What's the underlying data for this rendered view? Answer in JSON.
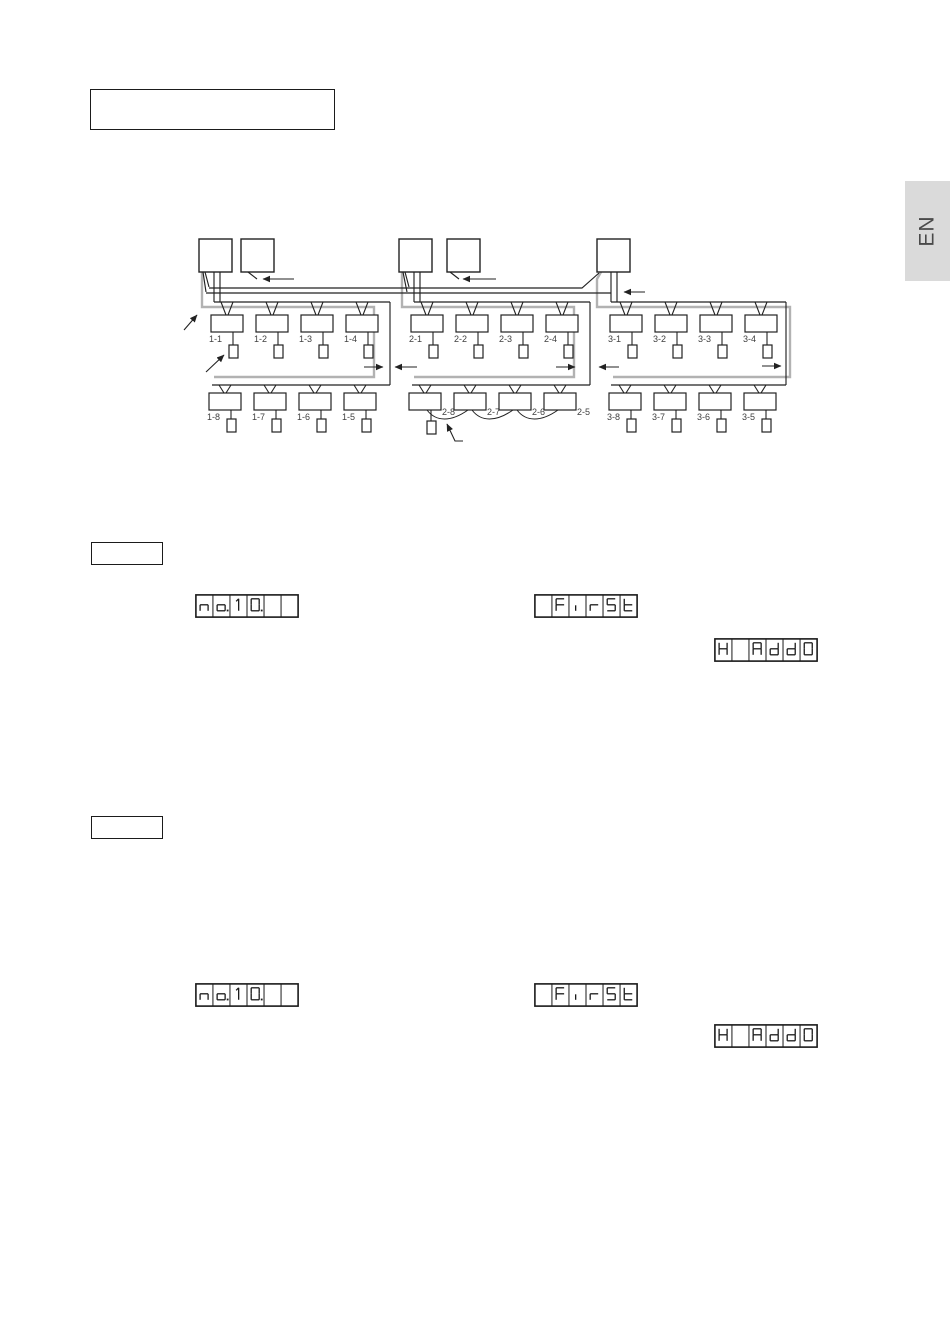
{
  "page": {
    "language_tab": "EN"
  },
  "diagram": {
    "groups": [
      {
        "id": "1",
        "outdoor_units": 2,
        "row1": [
          "1-1",
          "1-2",
          "1-3",
          "1-4"
        ],
        "row2": [
          "1-8",
          "1-7",
          "1-6",
          "1-5"
        ]
      },
      {
        "id": "2",
        "outdoor_units": 2,
        "row1": [
          "2-1",
          "2-2",
          "2-3",
          "2-4"
        ],
        "row2": [
          "2-8",
          "2-7",
          "2-6",
          "2-5"
        ],
        "row2_group_wiring": true
      },
      {
        "id": "3",
        "outdoor_units": 1,
        "row1": [
          "3-1",
          "3-2",
          "3-3",
          "3-4"
        ],
        "row2": [
          "3-8",
          "3-7",
          "3-6",
          "3-5"
        ]
      }
    ],
    "colors": {
      "line": "#222222",
      "bus_highlight": "#b2b2b2",
      "label": "#3f3f3f"
    }
  },
  "displays": [
    {
      "name": "no-10",
      "cells": [
        "n",
        "o.",
        "1",
        "0.",
        "",
        ""
      ]
    },
    {
      "name": "first",
      "cells": [
        "",
        "F",
        "i",
        "r",
        "S",
        "t"
      ]
    },
    {
      "name": "h-add0",
      "cells": [
        "H",
        "",
        "A",
        "d",
        "d",
        "0"
      ]
    },
    {
      "name": "no-10",
      "cells": [
        "n",
        "o.",
        "1",
        "0.",
        "",
        ""
      ]
    },
    {
      "name": "first",
      "cells": [
        "",
        "F",
        "i",
        "r",
        "S",
        "t"
      ]
    },
    {
      "name": "h-add0",
      "cells": [
        "H",
        "",
        "A",
        "d",
        "d",
        "0"
      ]
    }
  ]
}
